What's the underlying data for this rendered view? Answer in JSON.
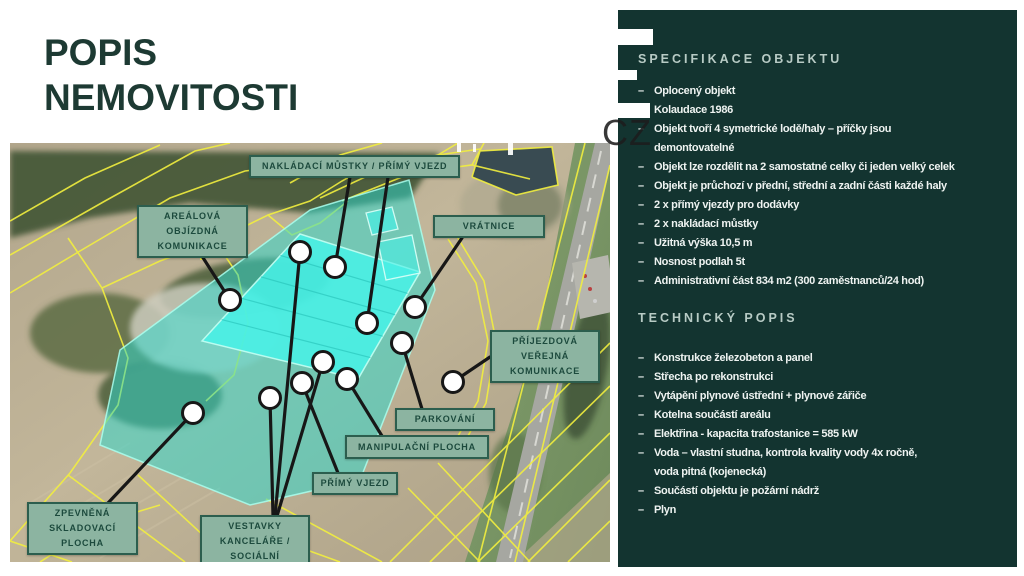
{
  "slide": {
    "title": [
      "POPIS",
      "NEMOVITOSTI"
    ]
  },
  "watermark": {
    "cz": "CZ"
  },
  "map": {
    "labels": [
      {
        "id": "nakladaci-mustky",
        "text": "NAKLÁDACÍ MŮSTKY / PŘÍMÝ VJEZD",
        "x": 239,
        "y": 12,
        "w": 0,
        "h": 22
      },
      {
        "id": "arealova-komunikace",
        "text": "AREÁLOVÁ OBJÍZDNÁ KOMUNIKACE",
        "x": 127,
        "y": 62,
        "w": 111,
        "h": 48
      },
      {
        "id": "vratnice",
        "text": "VRÁTNICE",
        "x": 423,
        "y": 72,
        "w": 112,
        "h": 23
      },
      {
        "id": "prijezdova-komunikace",
        "text": "PŘÍJEZDOVÁ VEŘEJNÁ KOMUNIKACE",
        "x": 480,
        "y": 187,
        "w": 110,
        "h": 47
      },
      {
        "id": "parkovani",
        "text": "PARKOVÁNÍ",
        "x": 385,
        "y": 265,
        "w": 100,
        "h": 23
      },
      {
        "id": "manipulacni-plocha",
        "text": "MANIPULAČNÍ PLOCHA",
        "x": 335,
        "y": 292,
        "w": 0,
        "h": 24
      },
      {
        "id": "primy-vjezd",
        "text": "PŘÍMÝ VJEZD",
        "x": 302,
        "y": 329,
        "w": 86,
        "h": 23
      },
      {
        "id": "vestavky",
        "text": "VESTAVKY KANCELÁŘE / SOCIÁLNÍ",
        "x": 190,
        "y": 372,
        "w": 110,
        "h": 48
      },
      {
        "id": "zpevnena-plocha",
        "text": "ZPEVNĚNÁ SKLADOVACÍ PLOCHA",
        "x": 17,
        "y": 359,
        "w": 111,
        "h": 48
      }
    ],
    "markers": [
      [
        290,
        109
      ],
      [
        325,
        124
      ],
      [
        220,
        157
      ],
      [
        405,
        164
      ],
      [
        357,
        180
      ],
      [
        392,
        200
      ],
      [
        443,
        239
      ],
      [
        313,
        219
      ],
      [
        337,
        236
      ],
      [
        292,
        240
      ],
      [
        260,
        255
      ],
      [
        183,
        270
      ]
    ],
    "connectors": [
      [
        340,
        34,
        325,
        124
      ],
      [
        378,
        34,
        357,
        180
      ],
      [
        190,
        110,
        220,
        157
      ],
      [
        452,
        95,
        405,
        164
      ],
      [
        480,
        214,
        443,
        239
      ],
      [
        412,
        266,
        392,
        200
      ],
      [
        372,
        293,
        337,
        236
      ],
      [
        328,
        330,
        292,
        240
      ],
      [
        265,
        373,
        290,
        109
      ],
      [
        267,
        373,
        313,
        219
      ],
      [
        263,
        373,
        260,
        255
      ],
      [
        98,
        360,
        183,
        270
      ]
    ]
  },
  "panel": {
    "bullet": "–",
    "sections": [
      {
        "heading": "SPECIFIKACE OBJEKTU",
        "items": [
          [
            "Oplocený objekt"
          ],
          [
            "Kolaudace 1986"
          ],
          [
            "Objekt tvoří 4 symetrické lodě/haly – příčky jsou",
            "demontovatelné"
          ],
          [
            "Objekt lze rozdělit na 2 samostatné celky či jeden velký celek"
          ],
          [
            "Objekt je průchozí v přední, střední a zadní části každé haly"
          ],
          [
            "2 x přímý vjezdy pro dodávky"
          ],
          [
            "2 x nakládací můstky"
          ],
          [
            "Užitná výška 10,5 m"
          ],
          [
            "Nosnost podlah 5t"
          ],
          [
            "Administrativní část 834 m2 (300 zaměstnanců/24 hod)"
          ]
        ]
      },
      {
        "heading": "TECHNICKÝ POPIS",
        "items": [
          [
            "Konstrukce železobeton a panel"
          ],
          [
            "Střecha po rekonstrukci"
          ],
          [
            "Vytápění plynové ústřední + plynové zářiče"
          ],
          [
            "Kotelna součástí areálu"
          ],
          [
            "Elektřina - kapacita trafostanice = 585 kW"
          ],
          [
            "Voda – vlastní studna, kontrola kvality vody 4x ročně,",
            "voda pitná (kojenecká)"
          ],
          [
            "Součástí objektu je požární nádrž"
          ],
          [
            "Plyn"
          ]
        ]
      }
    ]
  },
  "colors": {
    "panel_bg": "#133430",
    "panel_heading": "#b8cbc5",
    "label_bg": "#8cb4a1",
    "label_border": "#2c5e4e",
    "highlight_teal": "#2ed8cd",
    "cadastre_yellow": "#f2ef3f",
    "title_green": "#1d3a33"
  }
}
